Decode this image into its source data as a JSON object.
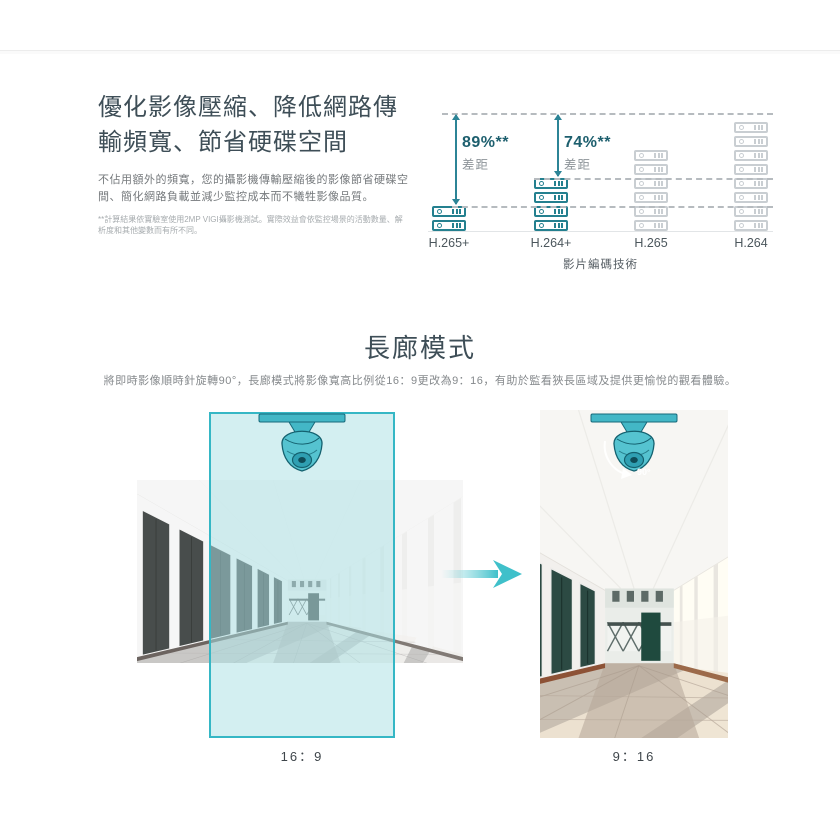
{
  "accent_colors": {
    "teal_accent": "#35b7c5",
    "teal_dark": "#1d5f6e",
    "icon_highlight": "#24808f",
    "icon_muted": "#c9ced2",
    "overlay_fill": "rgba(170,224,228,0.52)"
  },
  "icons": {
    "storage": "storage-disk-icon",
    "camera": "dome-camera-icon",
    "transform": "transform-arrow-icon",
    "rotation": "rotate-90-icon"
  },
  "section_compression": {
    "title_lines": [
      "優化影像壓縮、降低網路傳",
      "輸頻寬、節省硬碟空間"
    ],
    "description": "不佔用額外的頻寬，您的攝影機傳輸壓縮後的影像節省硬碟空間、簡化網路負載並減少監控成本而不犧牲影像品質。",
    "footnote": "**計算結果依實驗室使用2MP VIGI攝影機測試。實際效益會依監控場景的活動數量、解析度和其他變數而有所不同。"
  },
  "chart_data": {
    "type": "bar",
    "title": "",
    "categories": [
      "H.265+",
      "H.264+",
      "H.265",
      "H.264"
    ],
    "values": [
      2,
      4,
      6,
      8
    ],
    "value_unit": "relative storage usage (stacked disk icons)",
    "highlighted_categories": [
      "H.265+",
      "H.264+"
    ],
    "baseline_category": "H.264",
    "xlabel": "影片編碼技術",
    "ylabel": "",
    "grid": "dashed reference lines at baseline top and at H.265+ / H.264+ stack tops",
    "legend_position": "none",
    "annotations": [
      {
        "category": "H.265+",
        "label": "89%**",
        "sublabel": "差距"
      },
      {
        "category": "H.264+",
        "label": "74%**",
        "sublabel": "差距"
      }
    ]
  },
  "section_corridor": {
    "title": "長廊模式",
    "description": "將即時影像順時針旋轉90°，長廊模式將影像寬高比例從16：9更改為9：16，有助於監看狹長區域及提供更愉悅的觀看體驗。",
    "before_label": "16：9",
    "after_label": "9：16",
    "rotation_label": "90°"
  }
}
